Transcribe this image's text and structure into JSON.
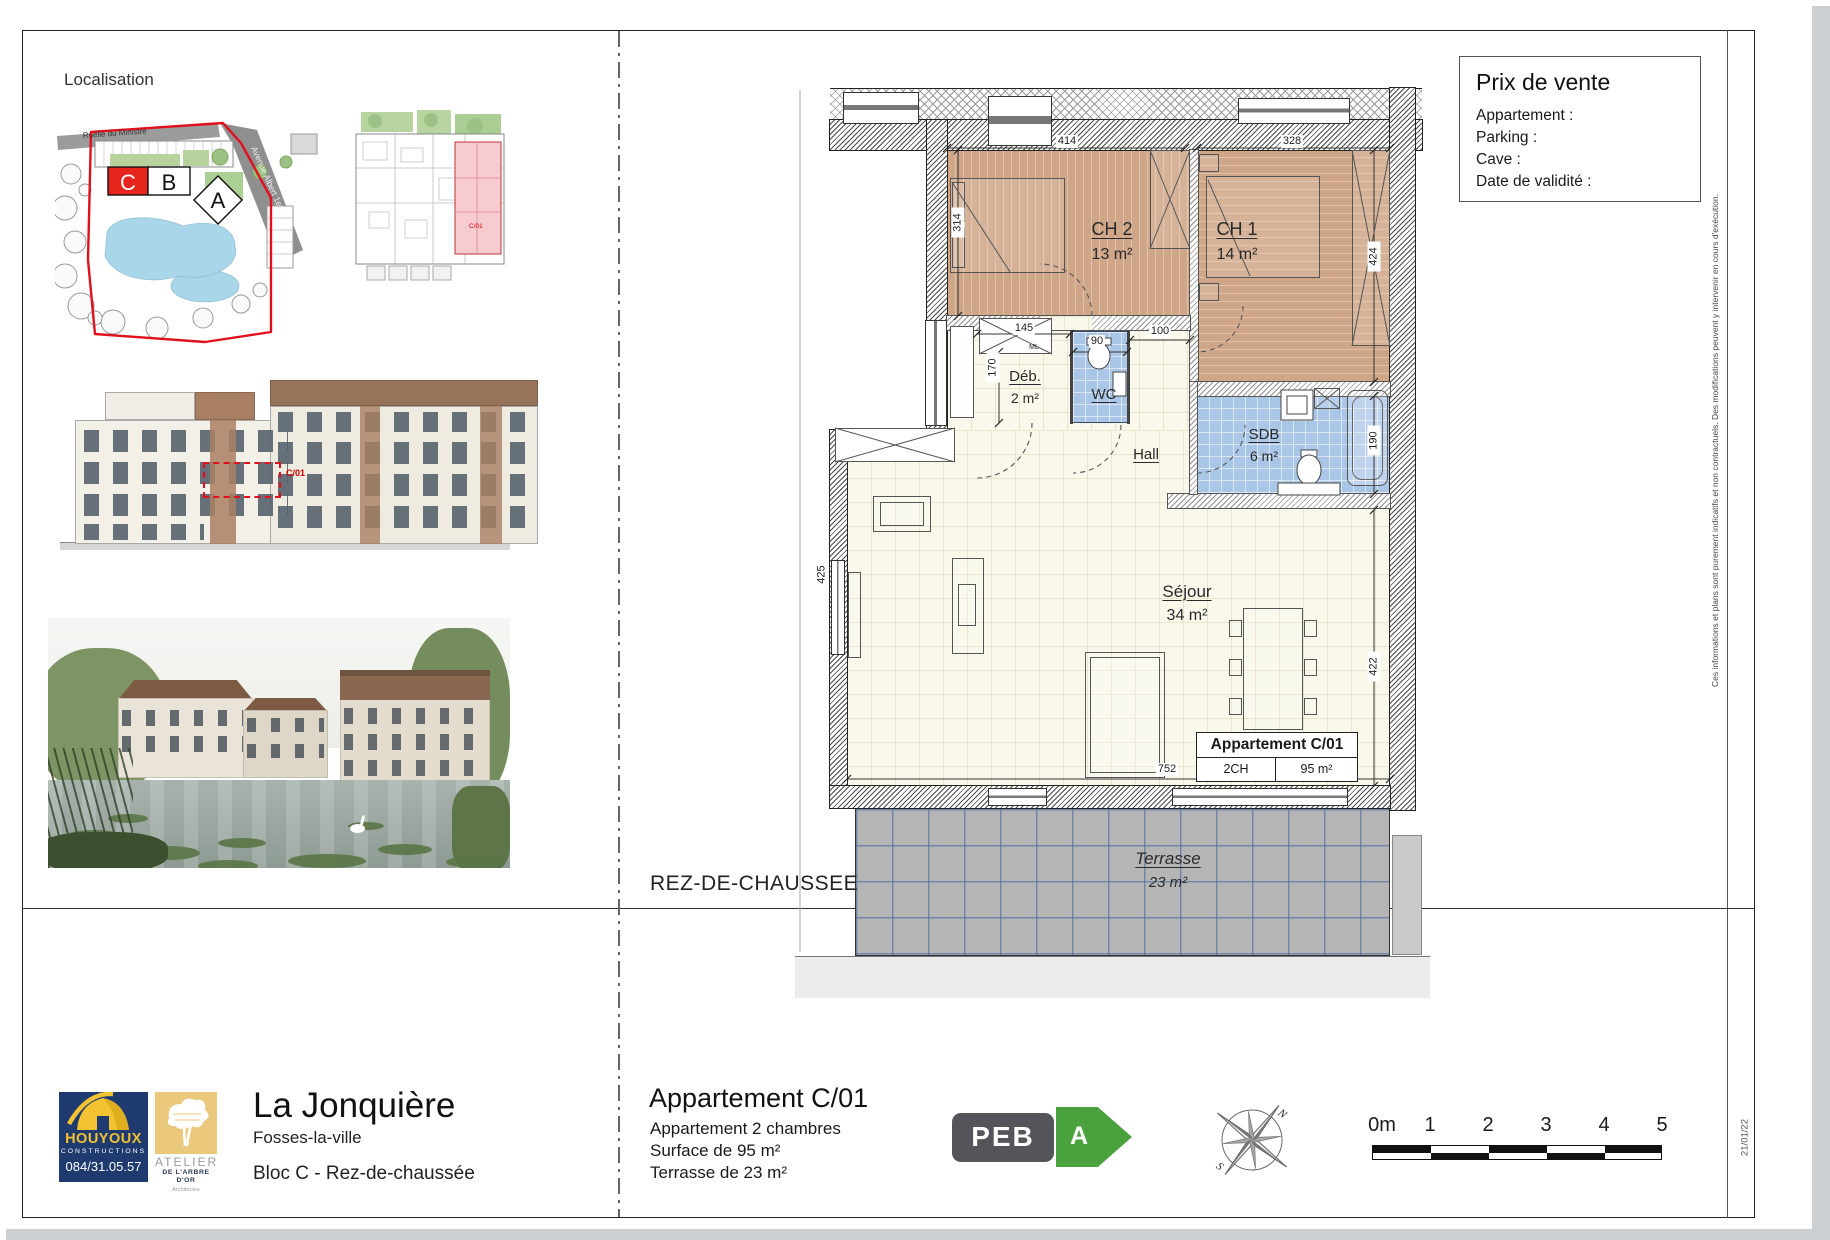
{
  "colors": {
    "accent_red": "#E0101C",
    "floor_wood": "#CFA687",
    "tile_blue": "#AAC6E6",
    "terrace_gray": "#B5B5B5",
    "houyoux_navy": "#1F3A6E",
    "houyoux_yellow": "#F2C233",
    "atelier_tan": "#EAC87C",
    "peb_gray": "#54555A",
    "peb_green": "#4AA23E"
  },
  "left": {
    "localisation": "Localisation",
    "siteplan": {
      "road1": "Ruelle du Ministre",
      "road2": "Avenue Albert 1er",
      "bldg_c": "C",
      "bldg_b": "B",
      "bldg_a": "A"
    },
    "miniplan": {
      "unit": "C/01"
    },
    "elevation": {
      "unit": "C/01"
    }
  },
  "price_box": {
    "title": "Prix de vente",
    "lines": [
      "Appartement :",
      "Parking :",
      "Cave :",
      "Date de validité :"
    ]
  },
  "plan": {
    "rooms": {
      "ch2": {
        "name": "CH 2",
        "area": "13 m²"
      },
      "ch1": {
        "name": "CH 1",
        "area": "14 m²"
      },
      "deb": {
        "name": "Déb.",
        "area": "2 m²"
      },
      "wc": {
        "name": "WC"
      },
      "hall": {
        "name": "Hall"
      },
      "sdb": {
        "name": "SDB",
        "area": "6 m²"
      },
      "sejour": {
        "name": "Séjour",
        "area": "34 m²"
      },
      "terrasse": {
        "name": "Terrasse",
        "area": "23 m²"
      }
    },
    "dims": {
      "top_ch2": "414",
      "top_ch1": "328",
      "left_ch2": "314",
      "right_ch1": "424",
      "deb_w": "145",
      "deb_h": "170",
      "wc_w": "90",
      "hall_w": "100",
      "sdb_h": "190",
      "sejour_h": "422",
      "sejour_left": "425",
      "sejour_w": "752",
      "ml": "ML"
    },
    "unit_table": {
      "title": "Appartement C/01",
      "bedrooms": "2CH",
      "area": "95 m²"
    },
    "level_label": "REZ-DE-CHAUSSEE"
  },
  "footer": {
    "houyoux": {
      "name": "HOUYOUX",
      "sub": "CONSTRUCTIONS",
      "phone": "084/31.05.57"
    },
    "atelier": {
      "line1": "ATELIER",
      "line2": "DE L'ARBRE D'OR",
      "line3": "Architectes"
    },
    "project": {
      "name": "La Jonquière",
      "city": "Fosses-la-ville",
      "block": "Bloc C - Rez-de-chaussée"
    },
    "apartment": {
      "title": "Appartement C/01",
      "line1": "Appartement 2 chambres",
      "line2": "Surface de 95 m²",
      "line3": "Terrasse de 23 m²"
    },
    "peb": {
      "label": "PEB",
      "grade": "A"
    },
    "compass": {
      "north": "N",
      "south": "S"
    },
    "scale": {
      "labels": [
        "0m",
        "1",
        "2",
        "3",
        "4",
        "5"
      ]
    },
    "date": "21/01/22"
  },
  "disclaimer": "Ces informations et plans sont purement indicatifs et non contractuels. Des modifications peuvent y intervenir en cours d'exécution."
}
